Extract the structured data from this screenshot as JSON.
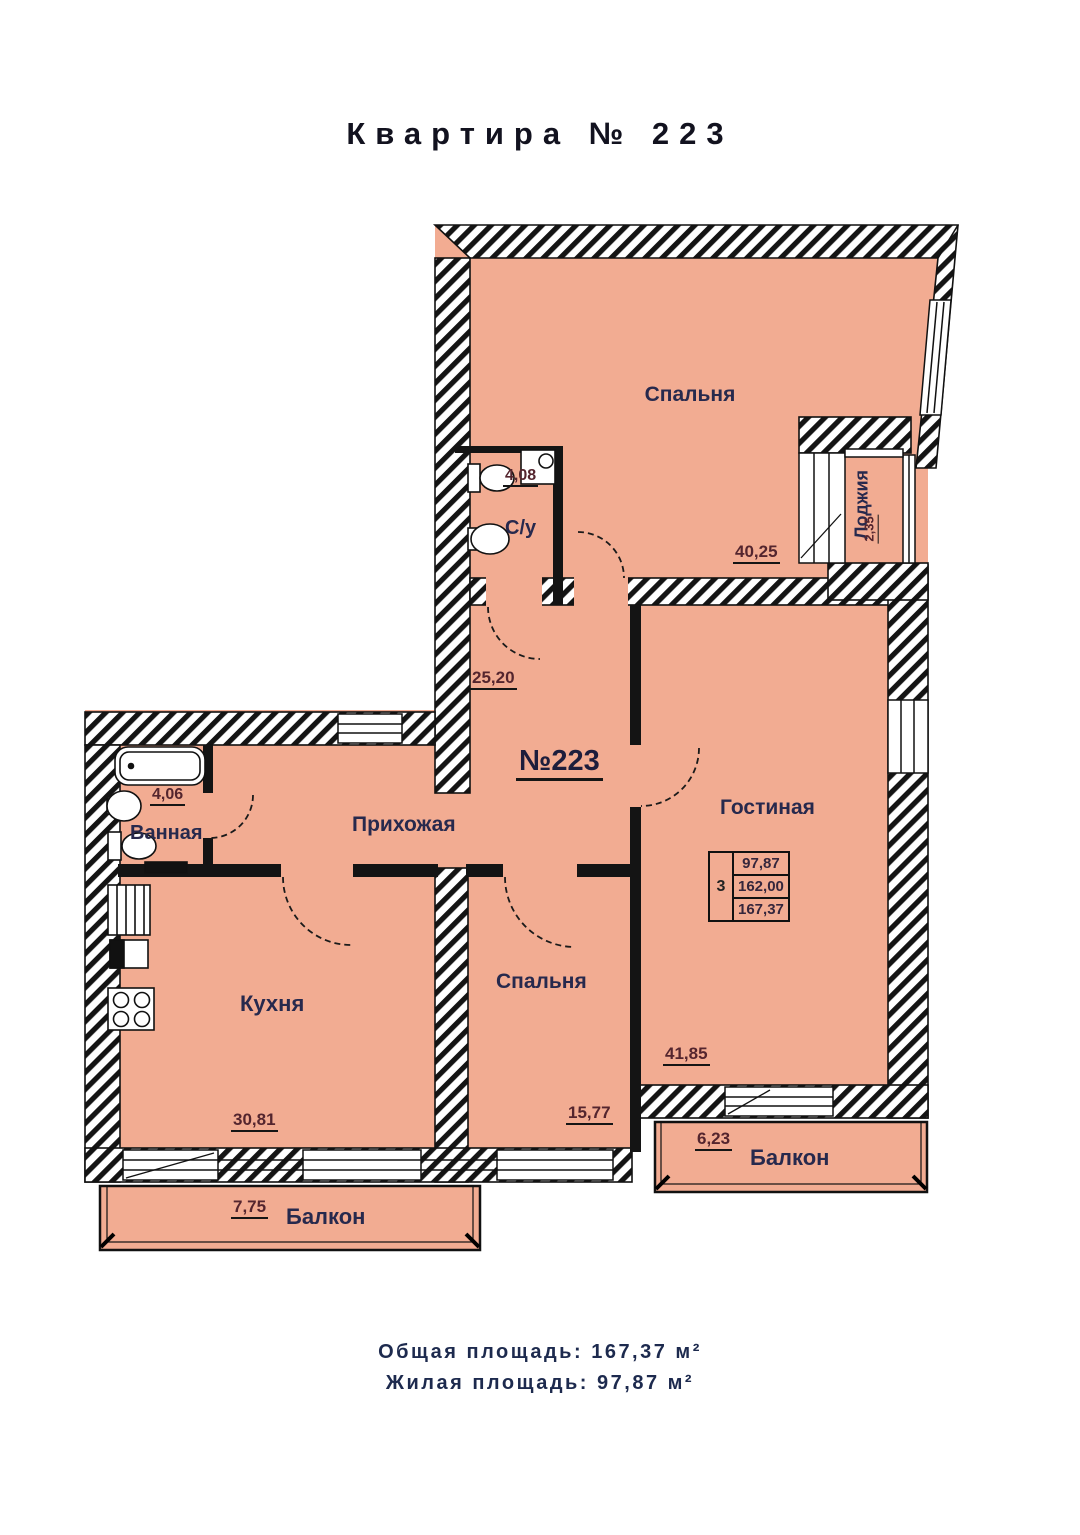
{
  "title": "Квартира № 223",
  "plan": {
    "apartment_number": "№223",
    "rooms": {
      "bedroom_top": {
        "label": "Спальня",
        "area": "40,25"
      },
      "su": {
        "label": "С/у",
        "area": "4,08"
      },
      "loggia": {
        "label": "Лоджия",
        "area": "2,35"
      },
      "hallway": {
        "label": "Прихожая",
        "area": "25,20"
      },
      "bathroom": {
        "label": "Ванная",
        "area": "4,06"
      },
      "kitchen": {
        "label": "Кухня",
        "area": "30,81"
      },
      "bedroom_bottom": {
        "label": "Спальня",
        "area": "15,77"
      },
      "living": {
        "label": "Гостиная",
        "area": "41,85"
      },
      "balcony_right": {
        "label": "Балкон",
        "area": "6,23"
      },
      "balcony_bottom": {
        "label": "Балкон",
        "area": "7,75"
      }
    },
    "info_table": {
      "rooms": "3",
      "values": [
        "97,87",
        "162,00",
        "167,37"
      ]
    },
    "colors": {
      "floor_fill": "#F2AC92",
      "wall_line": "#111111"
    }
  },
  "summary": {
    "total_line": "Общая площадь: 167,37 м²",
    "living_line": "Жилая площадь: 97,87 м²"
  }
}
